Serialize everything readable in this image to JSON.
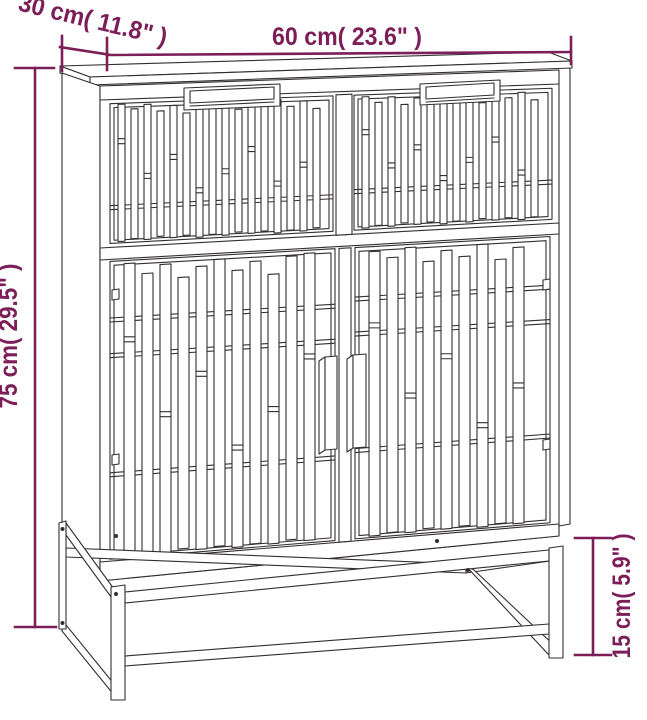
{
  "diagram": {
    "kind": "furniture-dimension-drawing",
    "accent_color": "#7c1e58",
    "line_color": "#332e31",
    "background_color": "#ffffff",
    "dimensions": {
      "width_label": "60 cm( 23.6\" )",
      "depth_label": "30 cm( 11.8\" )",
      "height_label": "75 cm( 29.5\" )",
      "leg_height_label": "15 cm( 5.9\" )"
    }
  }
}
